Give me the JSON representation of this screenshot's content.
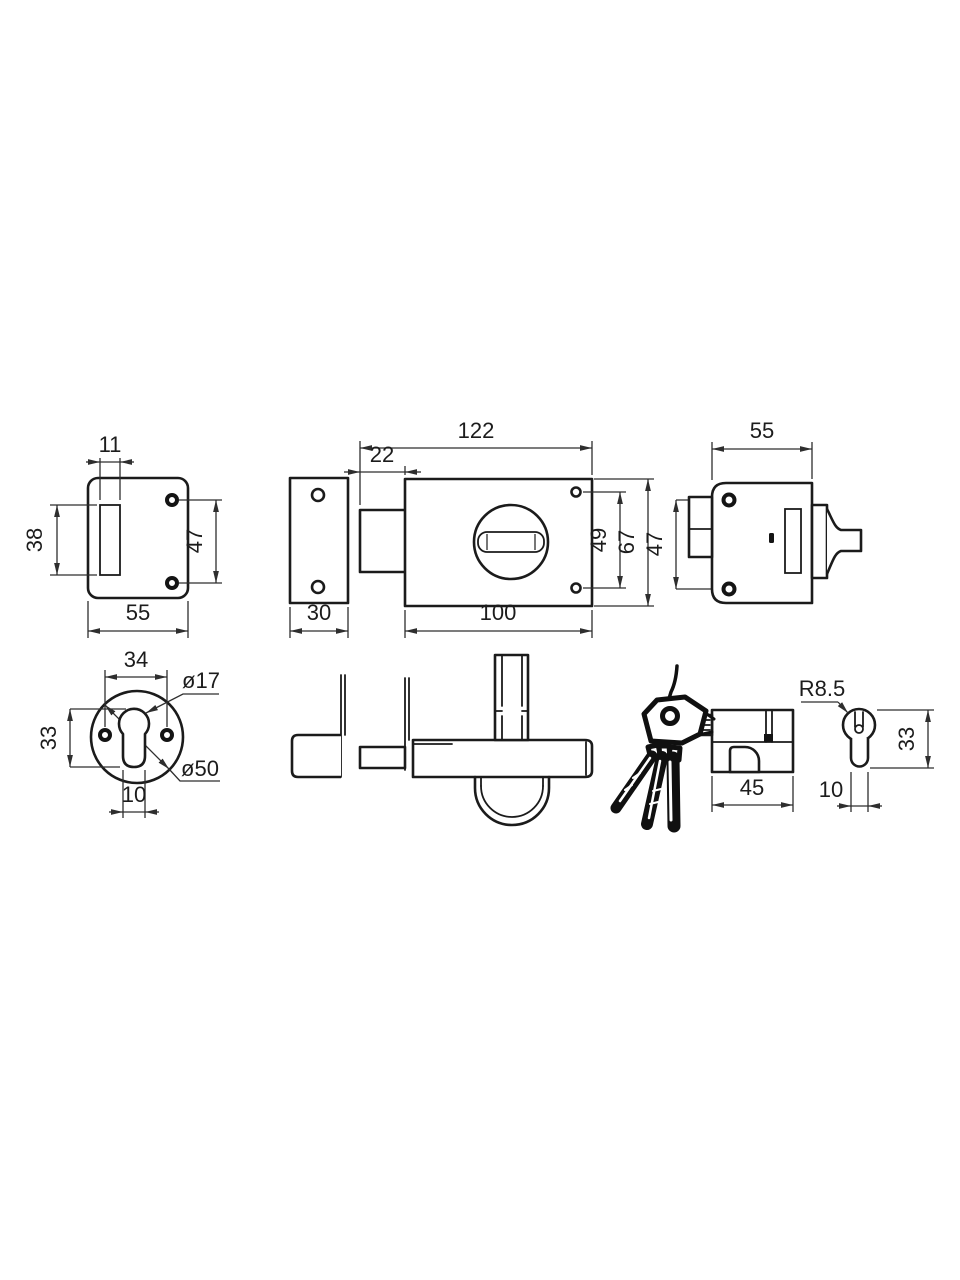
{
  "page": {
    "background": "#ffffff",
    "line_color": "#1b1b1b"
  },
  "drawing": {
    "type": "technical-drawing",
    "subject": "rim lock set: strike plate, lock case front, lock case rear, escutcheon, side profile, cylinder with keys",
    "views": {
      "strike_plate": {
        "dims": {
          "slot_width": "11",
          "slot_height": "38",
          "hole_spacing": "47",
          "plate_width": "55"
        }
      },
      "lock_front": {
        "dims": {
          "overall_length": "122",
          "bolt_throw": "22",
          "hole_spacing": "49",
          "body_height": "67",
          "body_length": "100",
          "faceplate_width": "30"
        }
      },
      "lock_rear": {
        "dims": {
          "body_width": "55",
          "hole_spacing": "47"
        }
      },
      "escutcheon": {
        "dims": {
          "hole_spacing": "34",
          "keyhole_diameter": "ø17",
          "keyhole_height": "33",
          "outer_diameter": "ø50",
          "slot_width": "10"
        }
      },
      "cylinder_side": {
        "dims": {
          "length": "45"
        }
      },
      "cylinder_end": {
        "dims": {
          "radius": "R8.5",
          "keyway_width": "10",
          "profile_height": "33"
        }
      }
    }
  }
}
